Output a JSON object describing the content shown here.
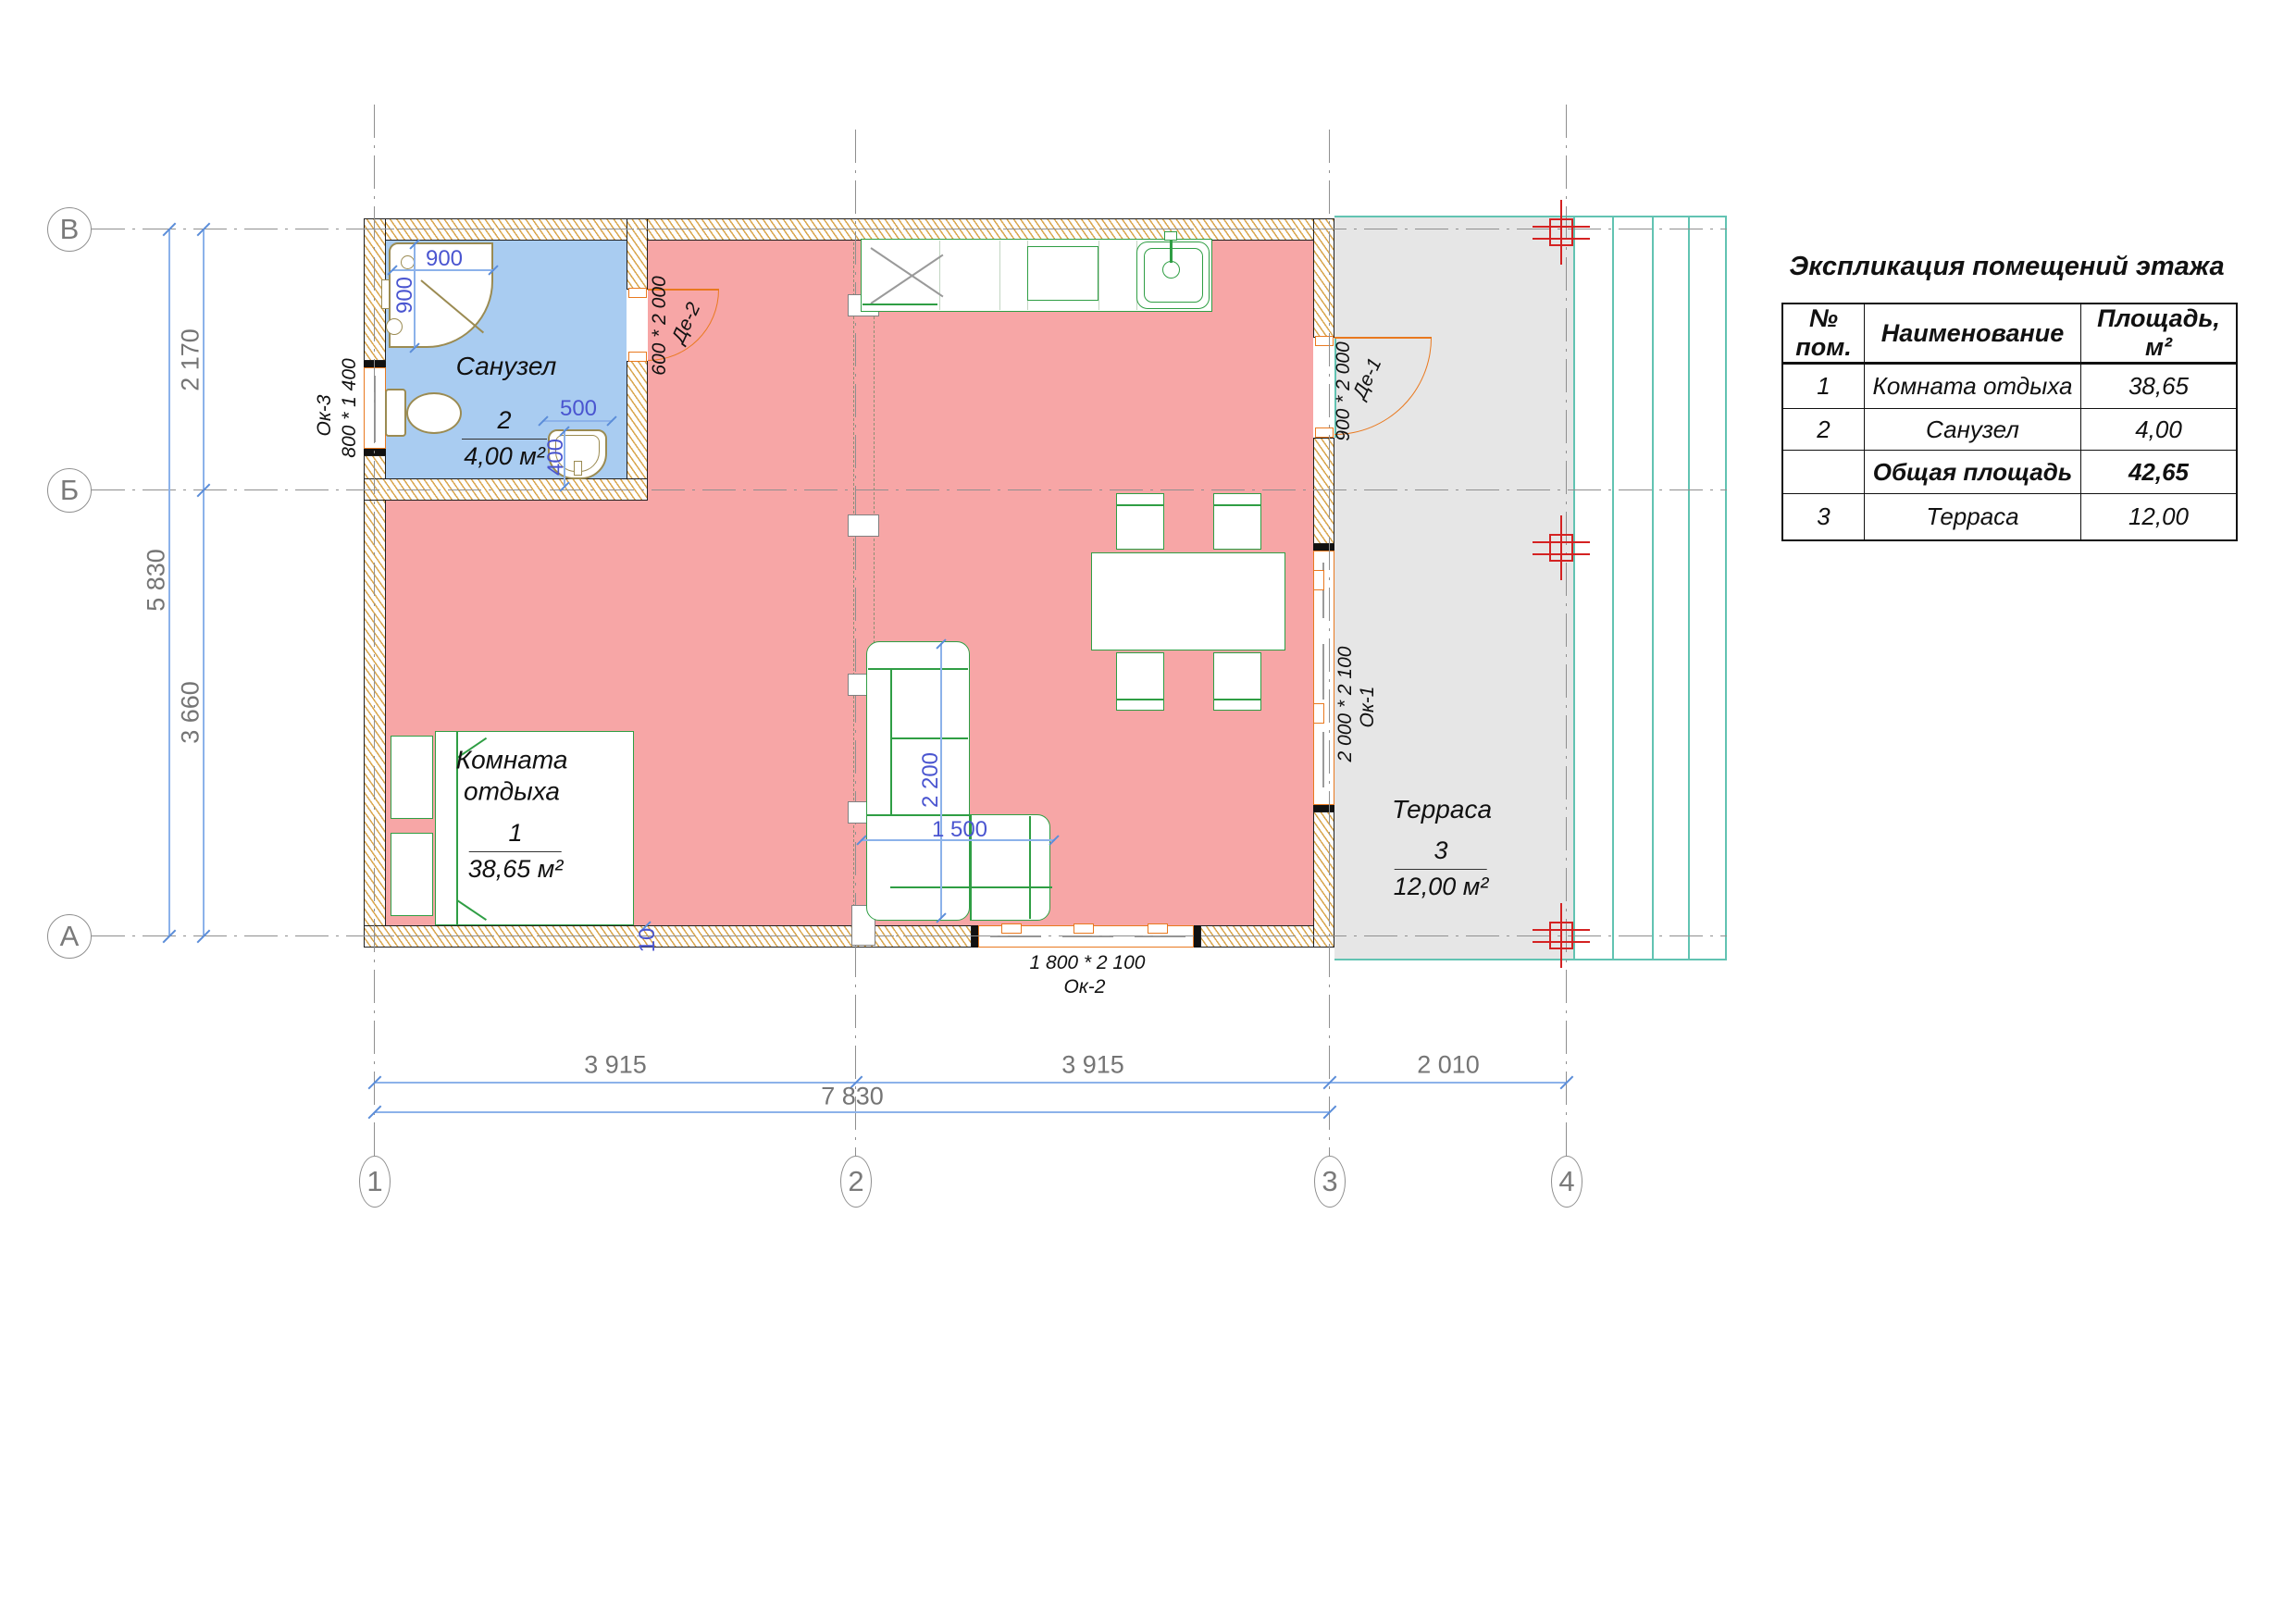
{
  "colors": {
    "room_pink": "#f7a6a6",
    "room_blue": "#a9ccf1",
    "terrace_gray": "#e6e6e6",
    "wall_hatch_tan": "#d59c3b",
    "furniture_green": "#2f9e44",
    "fixture_olive": "#9b8b52",
    "opening_orange": "#e9791f",
    "dim_line_blue": "#8cb2ea",
    "dim_text_blue": "#4a55d0",
    "grid_gray": "#8f8f8f",
    "terrace_teal": "#62c3b2",
    "column_red": "#d42222"
  },
  "axes": {
    "rows": [
      {
        "label": "В"
      },
      {
        "label": "Б"
      },
      {
        "label": "А"
      }
    ],
    "cols": [
      {
        "label": "1"
      },
      {
        "label": "2"
      },
      {
        "label": "3"
      },
      {
        "label": "4"
      }
    ]
  },
  "dimensions": {
    "left_inner_top": "2 170",
    "left_inner_bottom": "3 660",
    "left_outer": "5 830",
    "bottom_span1": "3 915",
    "bottom_span2": "3 915",
    "bottom_span3": "2 010",
    "bottom_total": "7 830",
    "wall_offset": "10"
  },
  "fixture_dims": {
    "shower_width": "900",
    "shower_depth": "900",
    "basin_width": "500",
    "basin_depth": "400",
    "sofa_length": "2 200",
    "sofa_width": "1 500"
  },
  "openings": {
    "ok3": {
      "code": "Ок-3",
      "size": "800 * 1 400"
    },
    "de2": {
      "code": "Де-2",
      "size": "600 * 2 000"
    },
    "de1": {
      "code": "Де-1",
      "size": "900 * 2 000"
    },
    "ok1": {
      "code": "Ок-1",
      "size": "2 000 * 2 100"
    },
    "ok2": {
      "code": "Ок-2",
      "size": "1 800 * 2 100"
    }
  },
  "rooms": {
    "bathroom": {
      "name": "Санузел",
      "number": "2",
      "area": "4,00 м²"
    },
    "lounge": {
      "name_line1": "Комната",
      "name_line2": "отдыха",
      "number": "1",
      "area": "38,65 м²"
    },
    "terrace": {
      "name": "Терраса",
      "number": "3",
      "area": "12,00 м²"
    }
  },
  "explication": {
    "title": "Экспликация помещений этажа",
    "headers": [
      "№ пом.",
      "Наименование",
      "Площадь, м²"
    ],
    "rows": [
      {
        "num": "1",
        "name": "Комната отдыха",
        "area": "38,65"
      },
      {
        "num": "2",
        "name": "Санузел",
        "area": "4,00"
      },
      {
        "num": "",
        "name": "Общая площадь",
        "area": "42,65"
      },
      {
        "num": "3",
        "name": "Терраса",
        "area": "12,00"
      }
    ]
  }
}
